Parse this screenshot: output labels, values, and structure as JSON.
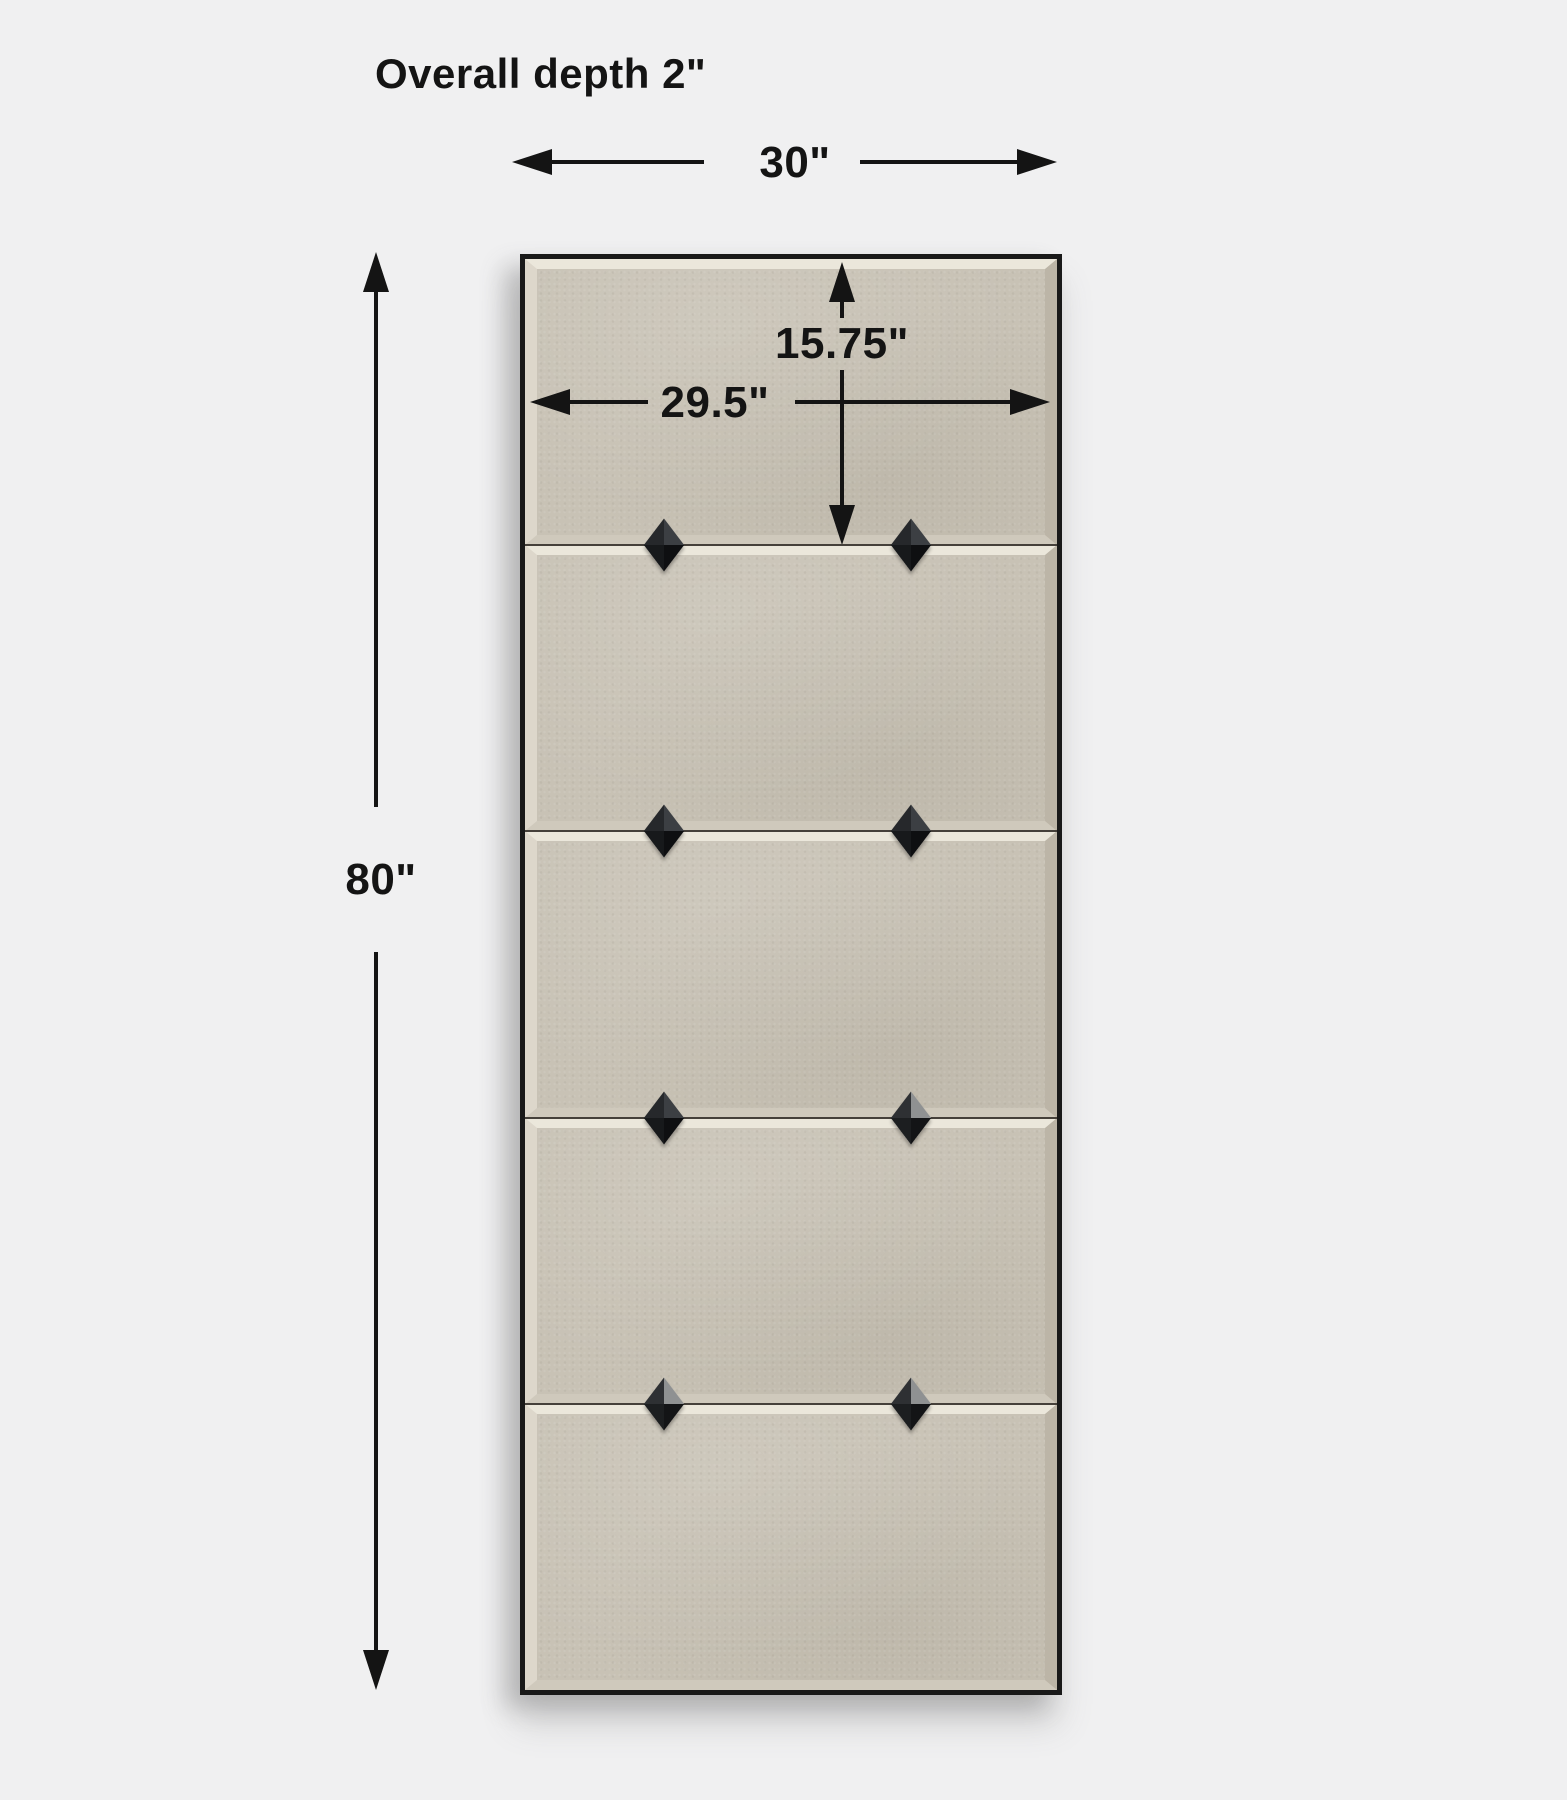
{
  "page": {
    "background": "#f0f0f1",
    "ink": "#141414"
  },
  "labels": {
    "overall_depth": "Overall depth 2\"",
    "overall_width": "30\"",
    "overall_height": "80\"",
    "mirror_width": "29.5\"",
    "panel_height": "15.75\""
  },
  "product": {
    "description": "five-panel beveled wall mirror, front elevation",
    "frame_color": "#191919",
    "mirror_color": "#c8c2b5",
    "bevel_colors": {
      "top": "#ebe7db",
      "left": "#ddd7cb",
      "right": "#bcb5a7",
      "bottom": "#cfc9bc",
      "outer_bottom": "#b8b1a3"
    },
    "junction_line_color": "#45403a",
    "sections": 5,
    "stud_columns_px": [
      139,
      386
    ],
    "junction_stud_variants": [
      [
        "dark",
        "dark"
      ],
      [
        "dark",
        "dark"
      ],
      [
        "dark",
        "highlight"
      ],
      [
        "highlight",
        "highlight"
      ]
    ],
    "stud_facets": {
      "dark": {
        "top": "#3c3f43",
        "right": "#0e0f11",
        "bottom": "#17191b",
        "left": "#26282b"
      },
      "highlight": {
        "top": "#8f9192",
        "right": "#131416",
        "bottom": "#1c1e20",
        "left": "#2e3033"
      }
    }
  }
}
